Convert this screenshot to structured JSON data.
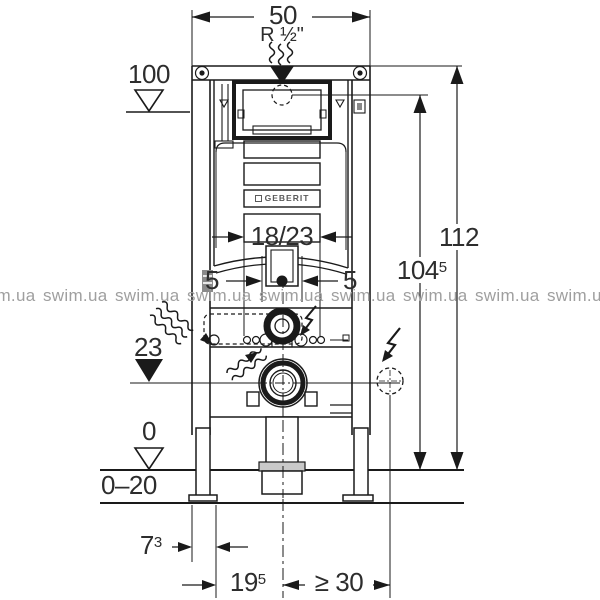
{
  "watermark": {
    "text": "swim.ua"
  },
  "brand": {
    "label": "GEBERIT"
  },
  "dims": {
    "width_top": "50",
    "thread": "R ½\"",
    "h100": "100",
    "h112": "112",
    "h104": {
      "base": "104",
      "sup": "5"
    },
    "panel": "18/23",
    "five_left": "5",
    "five_right": "5",
    "h23": "23",
    "zero": "0",
    "floor_range": "0–20",
    "d73": {
      "base": "7",
      "sup": "3"
    },
    "d195": {
      "base": "19",
      "sup": "5"
    },
    "clearance": "≥ 30"
  },
  "colors": {
    "line": "#1a1a1a",
    "watermark": "#9f9f9f",
    "text": "#2d2d2d"
  }
}
